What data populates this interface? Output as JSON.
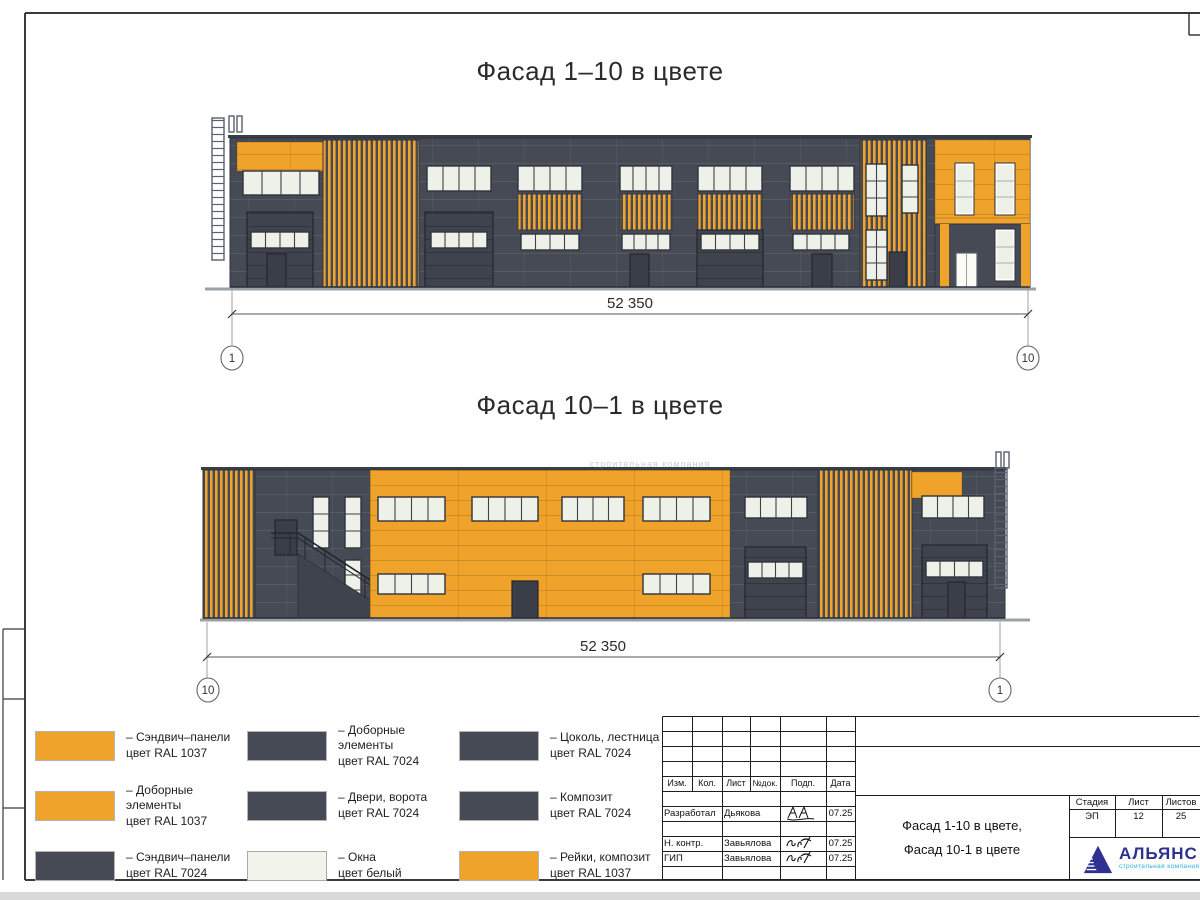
{
  "colors": {
    "orange": "#F0A32B",
    "dark_panel": "#454A55",
    "dark_door": "#3A3E48",
    "window": "#EEF1E8",
    "outline": "#2F333D",
    "logo_blue": "#2E3192",
    "logo_teal": "#29ABE2"
  },
  "titles": {
    "facade_top": "Фасад 1–10 в цвете",
    "facade_bottom": "Фасад 10–1 в цвете"
  },
  "dimensions": {
    "top": {
      "length": "52 350",
      "axis_left": "1",
      "axis_right": "10"
    },
    "bottom": {
      "length": "52 350",
      "axis_left": "10",
      "axis_right": "1"
    }
  },
  "watermark": "строительная компания",
  "legend": {
    "items": [
      {
        "color": "orange",
        "line1": "– Сэндвич–панели",
        "line2": "цвет RAL 1037"
      },
      {
        "color": "dark",
        "line1": "– Доборные элементы",
        "line2": "цвет RAL 7024"
      },
      {
        "color": "dark",
        "line1": "– Цоколь, лестница",
        "line2": "цвет RAL 7024"
      },
      {
        "color": "orange",
        "line1": "– Доборные элементы",
        "line2": "цвет RAL 1037"
      },
      {
        "color": "dark",
        "line1": "– Двери, ворота",
        "line2": "цвет RAL 7024"
      },
      {
        "color": "dark",
        "line1": "– Композит",
        "line2": "цвет RAL 7024"
      },
      {
        "color": "dark",
        "line1": "– Сэндвич–панели",
        "line2": "цвет RAL 7024"
      },
      {
        "color": "white",
        "line1": "– Окна",
        "line2": "цвет белый"
      },
      {
        "color": "orange",
        "line1": "– Рейки, композит",
        "line2": "цвет RAL 1037"
      }
    ]
  },
  "title_block": {
    "header_cols": [
      "Изм.",
      "Кол.",
      "Лист",
      "№док.",
      "Подп.",
      "Дата"
    ],
    "rows": [
      {
        "role": "Разработал",
        "name": "Дьякова",
        "date": "07.25"
      },
      {
        "role": "Н. контр.",
        "name": "Завьялова",
        "date": "07.25"
      },
      {
        "role": "ГИП",
        "name": "Завьялова",
        "date": "07.25"
      }
    ],
    "stage_headers": [
      "Стадия",
      "Лист",
      "Листов"
    ],
    "stage_values": [
      "ЭП",
      "12",
      "25"
    ],
    "doc_title_line1": "Фасад 1-10 в цвете,",
    "doc_title_line2": "Фасад 10-1 в цвете",
    "logo_name": "АЛЬЯНС",
    "logo_subtitle": "строительная компания"
  }
}
